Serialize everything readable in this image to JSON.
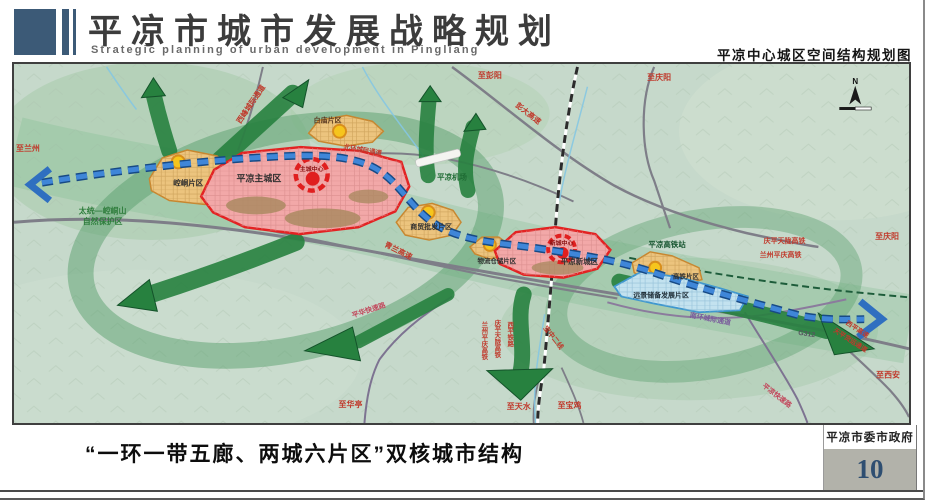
{
  "header": {
    "title_cn": "平凉市城市发展战略规划",
    "title_en": "Strategic planning of urban development in Pingliang",
    "map_subtitle": "平凉中心城区空间结构规划图"
  },
  "map": {
    "labels": {
      "to_lanzhou": "至兰州",
      "xifeng_corridor": "西峰城际通道",
      "to_pengyang": "至彭阳",
      "to_qingyang_top": "至庆阳",
      "pengda_expwy": "彭大高速",
      "baimiao_zone": "白庙片区",
      "north_ring": "北环城际通道",
      "airport": "平凉机场",
      "kongtong_zone": "崆峒片区",
      "main_city_zone": "平凉主城区",
      "main_core": "主城中心",
      "nature_reserve_1": "太统—崆峒山",
      "nature_reserve_2": "自然保护区",
      "trade_zone": "商贸批发片区",
      "qinglan_expwy": "青兰高速",
      "logistics_zone": "物流仓储片区",
      "new_city_zone": "平凉新城区",
      "new_core": "新城中心",
      "hsr_station": "平凉高铁站",
      "qptl_hsr": "庆平天陇高铁",
      "lzpq_hsr": "兰州平庆高铁",
      "to_qingyang_right": "至庆阳",
      "hsr_zone": "高铁片区",
      "reserve_zone": "远景储备发展片区",
      "south_ring": "南环城际通道",
      "g312": "G312",
      "xiping_expwy": "西平高速",
      "tianping_corridor": "天平货运通道",
      "to_xian": "至西安",
      "pingliang_expwy": "平凉快速路",
      "pinghua_expwy": "平华快速路",
      "to_huating": "至华亭",
      "baozhong_line": "宝中二线",
      "lzpq_hsr_v": "兰州平庆高铁",
      "qptl_hsr_v": "庆平天陇高铁",
      "xiping_rail_v": "西平铁路",
      "to_tianshui": "至天水",
      "to_baoji": "至宝鸡",
      "compass_n": "N"
    },
    "colors": {
      "accent_blue": "#3c5a77",
      "zone_orange": "#ecc47e",
      "zone_red": "#f2a8a8",
      "zone_blue": "#c3e2ef",
      "corridor_green": "#27813f",
      "transit_blue": "#3f86d8",
      "label_red": "#c0392b"
    }
  },
  "footer": {
    "caption": "“一环一带五廊、两城六片区”双核城市结构",
    "credit": "平凉市委市政府",
    "page_number": "10"
  }
}
